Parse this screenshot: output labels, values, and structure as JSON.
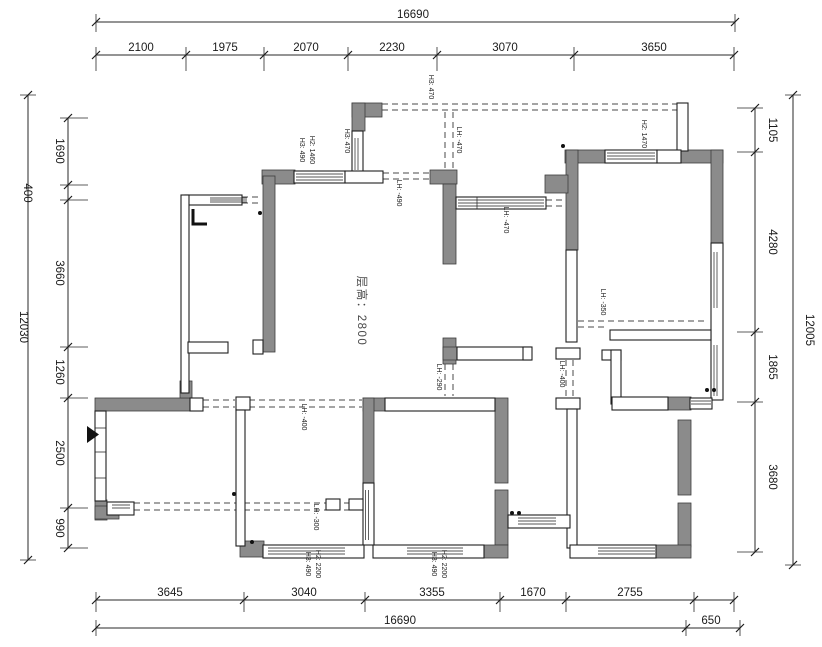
{
  "plan": {
    "floor_height": "层高：2800"
  },
  "dims": {
    "top": {
      "total": "16690",
      "segments": [
        "2100",
        "1975",
        "2070",
        "2230",
        "3070",
        "3650"
      ]
    },
    "left": {
      "total": "12030",
      "segments": [
        "1690",
        "400",
        "3660",
        "1260",
        "2500",
        "990"
      ]
    },
    "right": {
      "total": "12005",
      "segments": [
        "1105",
        "4280",
        "1865",
        "3680"
      ]
    },
    "bottom": {
      "total": "16690",
      "extra": "650",
      "segments": [
        "3645",
        "3040",
        "3355",
        "1670",
        "2755"
      ]
    }
  },
  "annotations": [
    {
      "text": "H3: 490"
    },
    {
      "text": "H2: 1460"
    },
    {
      "text": "H3: 470"
    },
    {
      "text": "H3: 470"
    },
    {
      "text": "LH: -470"
    },
    {
      "text": "LH: -490"
    },
    {
      "text": "LH: -470"
    },
    {
      "text": "H2: 1470"
    },
    {
      "text": "LH: -350"
    },
    {
      "text": "LH: -290"
    },
    {
      "text": "LH: -400"
    },
    {
      "text": "LH: -400"
    },
    {
      "text": "LH: -300"
    },
    {
      "text": "H3: 490"
    },
    {
      "text": "H2: 2200"
    },
    {
      "text": "H3: 490"
    },
    {
      "text": "H2: 2200"
    }
  ],
  "colors": {
    "wall_gray": "#8b8b8b",
    "line": "#1a1a1a",
    "dash": "#4a4a4a",
    "background": "#ffffff"
  }
}
